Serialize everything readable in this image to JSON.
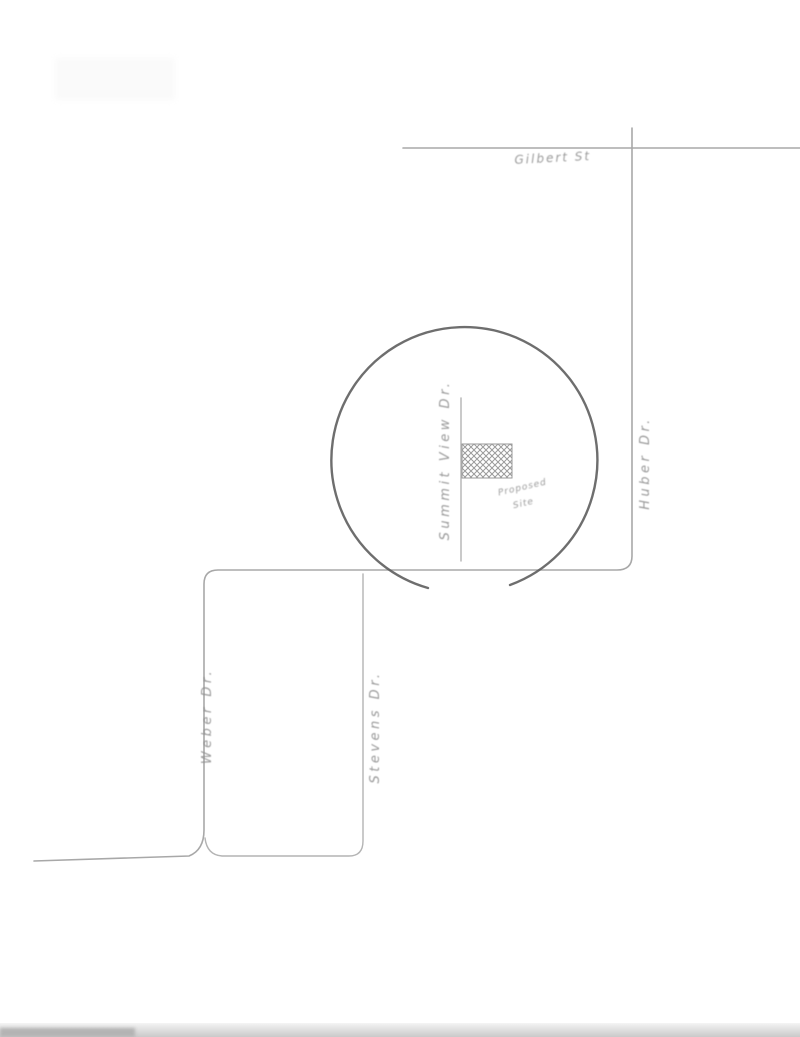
{
  "colors": {
    "paper": "#ffffff",
    "ink-street": "#a8a8a8",
    "ink-street-light": "#b4b4b4",
    "ink-circle": "#5a5a5a",
    "ink-text": "#8f8f8f",
    "ink-hatch": "#9a9a9a",
    "edge-shadow": "#c9c9c9"
  },
  "map": {
    "streets": {
      "top": {
        "label": "Gilbert St"
      },
      "right": {
        "label": "Huber Dr."
      },
      "inner": {
        "label": "Summit View Dr."
      },
      "left": {
        "label": "Weber Dr."
      },
      "loop": {
        "label": "Stevens Dr."
      }
    },
    "site": {
      "annotation_line1": "Proposed",
      "annotation_line2": "Site"
    }
  }
}
